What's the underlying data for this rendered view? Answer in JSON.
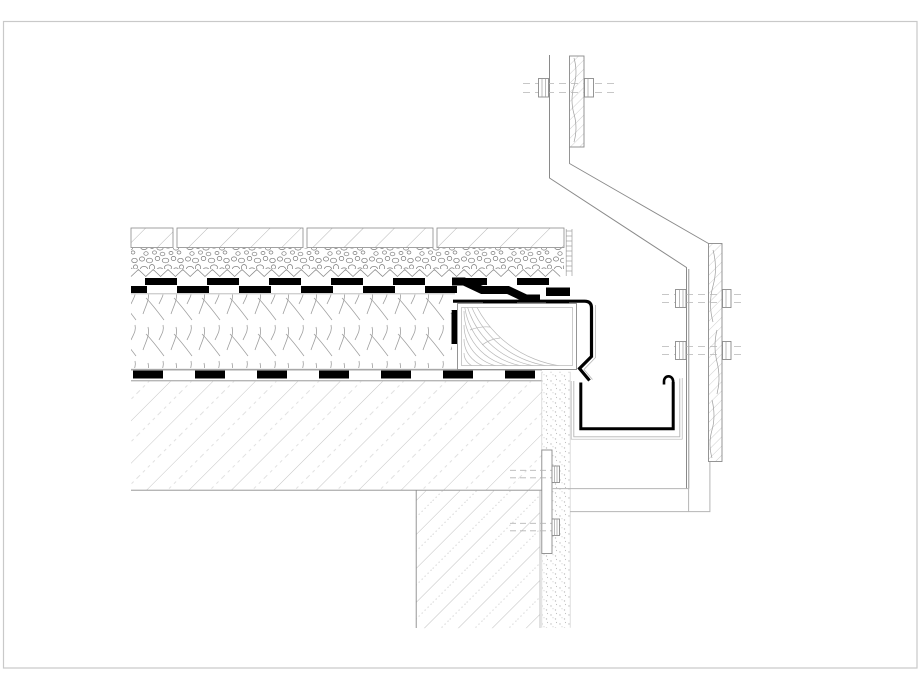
{
  "canvas": {
    "width": 920,
    "height": 690,
    "background": "#ffffff"
  },
  "colors": {
    "ink": "#000000",
    "line": "#8a8a8a",
    "faint": "#b5b5b5",
    "hatch": "#9e9e9e",
    "lighter": "#c6c6c6",
    "border": "#c9c9c9",
    "stipple": "#c0c0c0",
    "paper": "#ffffff"
  },
  "drawing": {
    "type": "architectural-detail-section",
    "components": [
      "page-border",
      "paving-slabs",
      "gravel-ballast",
      "protection-fleece",
      "waterproofing-membrane",
      "membrane-step",
      "thermal-insulation",
      "vapor-barrier",
      "concrete-roof-slab",
      "timber-blocking",
      "metal-flashing",
      "drip-edge",
      "edge-trim-ladder",
      "box-gutter",
      "cladding-bracket",
      "timber-batten-top",
      "timber-batten-right",
      "hex-bolt",
      "anchor-bolt",
      "parapet-wall",
      "render-coat",
      "fixing-plate",
      "soffit-panel"
    ]
  }
}
